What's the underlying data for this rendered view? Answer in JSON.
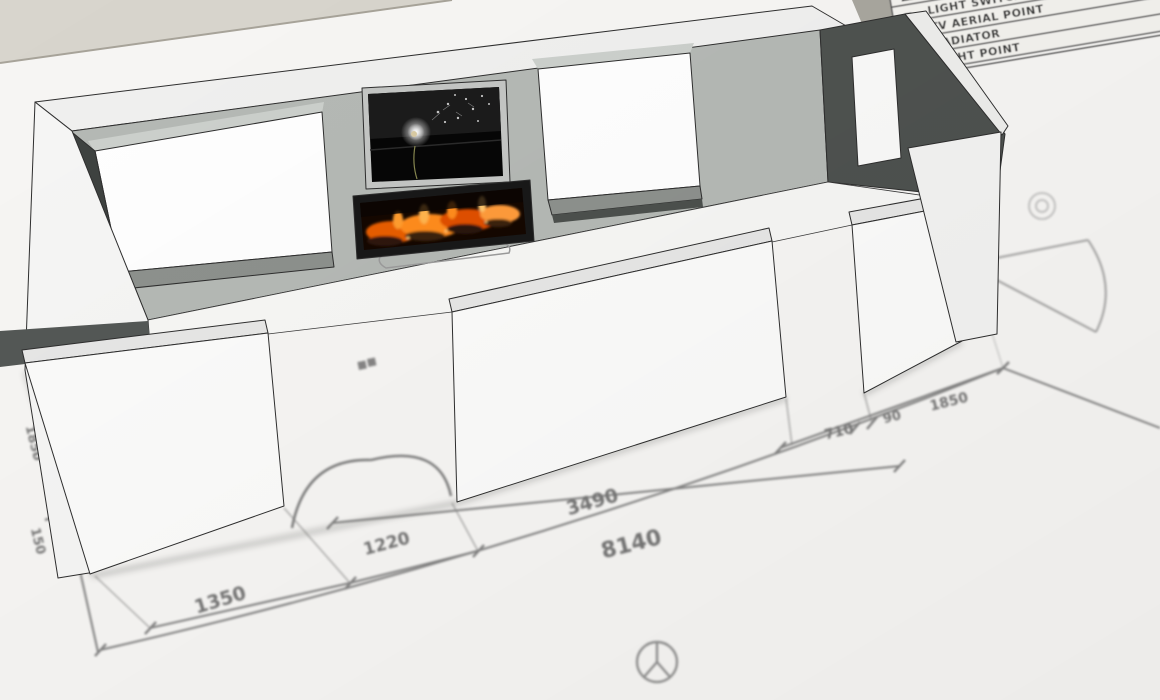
{
  "scene": {
    "app_view": "3d-room-model-over-floor-plan",
    "background_color": "#d8d5cd",
    "paper_color": "#f7f6f4"
  },
  "legend": {
    "rows": [
      {
        "symbol": "ΔΔ",
        "label": "DOUBLE SOCKET"
      },
      {
        "symbol": "⌐",
        "label": "LIGHT SWITCH"
      },
      {
        "symbol": "◅",
        "label": "TV AERIAL POINT"
      },
      {
        "symbol": "―",
        "label": "RADIATOR"
      },
      {
        "symbol": "⊕",
        "label": "LIGHT POINT"
      }
    ]
  },
  "plan": {
    "dimensions": [
      {
        "id": "overall-width",
        "value": "8140"
      },
      {
        "id": "center-wall-width",
        "value": "3490"
      },
      {
        "id": "left-corner-to-door",
        "value": "1350"
      },
      {
        "id": "left-door-width",
        "value": "1220"
      },
      {
        "id": "right-door-width",
        "value": "710"
      },
      {
        "id": "right-door-jamb",
        "value": "90"
      },
      {
        "id": "door-to-right-corner",
        "value": "1850"
      },
      {
        "id": "left-side-depth",
        "value": "1850"
      },
      {
        "id": "left-side-offset",
        "value": "150"
      }
    ],
    "symbols": [
      "light-point-circle",
      "double-socket",
      "double-door-swing-arcs",
      "single-door-swing"
    ]
  },
  "model": {
    "parts": [
      "back-wall",
      "left-window",
      "tv-screen",
      "fireplace",
      "right-window",
      "front-wall-left",
      "left-doorway",
      "front-wall-middle",
      "right-doorway",
      "front-wall-right",
      "right-wall",
      "floor",
      "hearth"
    ],
    "tv_image": "dandelion-with-flying-seeds",
    "fireplace_state": "lit",
    "colors": {
      "wall_interior": "#b5b9b5",
      "wall_white": "#fbfbfb",
      "reveal_dark": "#4e524f",
      "fire_orange": "#ff8c1e",
      "plan_ink": "#696969"
    }
  }
}
